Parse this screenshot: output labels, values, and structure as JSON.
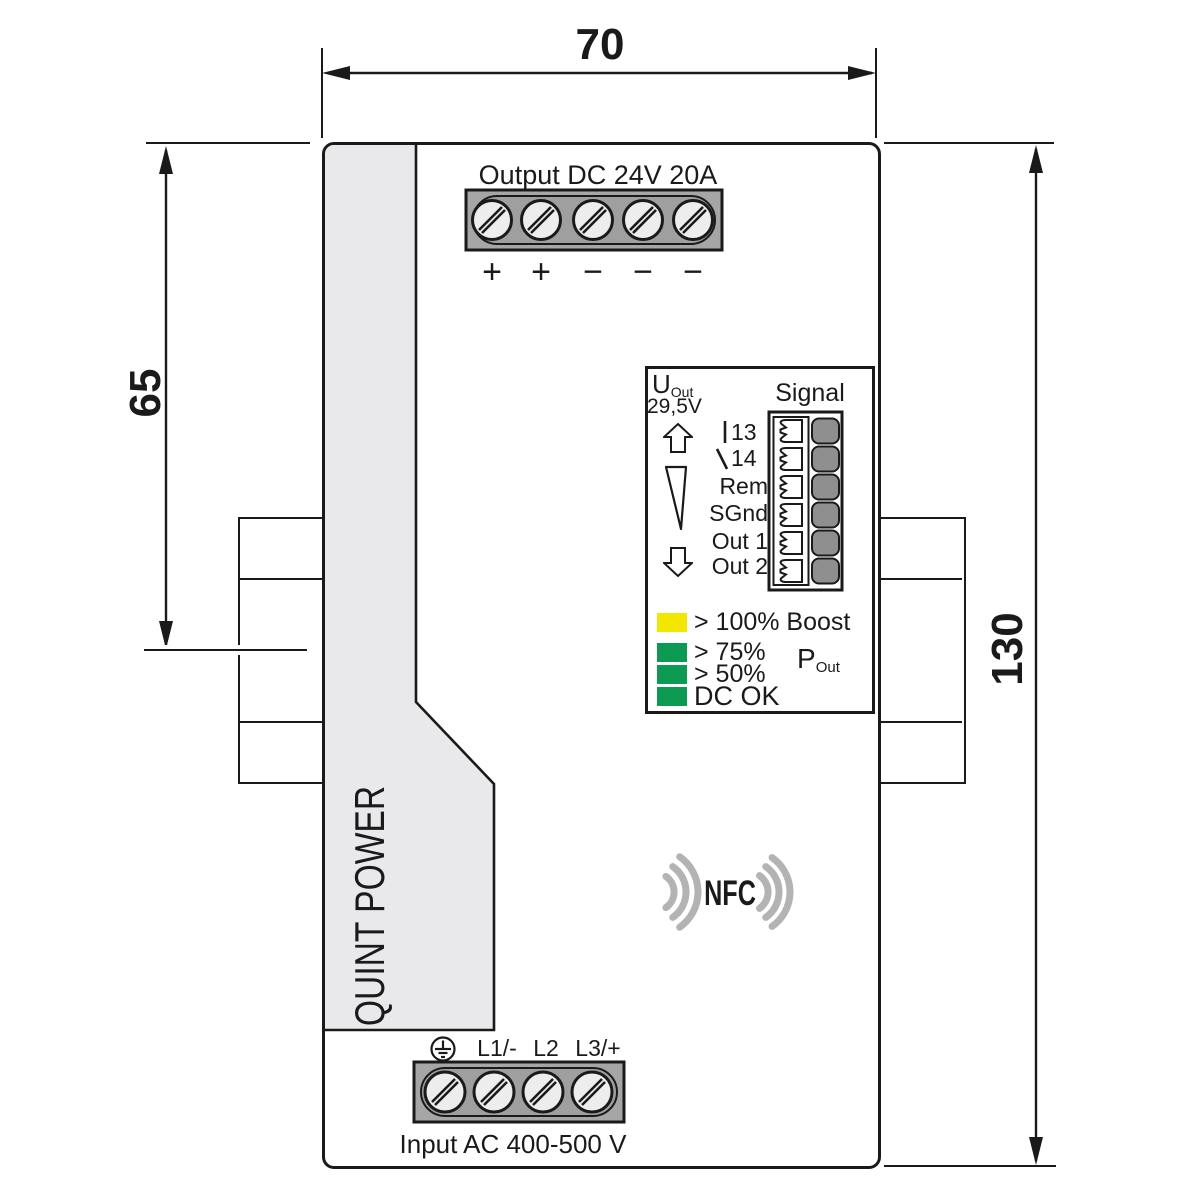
{
  "diagram": {
    "dim_width": "70",
    "dim_side_height": "65",
    "dim_total_height": "130"
  },
  "output": {
    "title": "Output DC 24V 20A",
    "polarity": [
      "+",
      "+",
      "−",
      "−",
      "−"
    ]
  },
  "signal_panel": {
    "u_label": "U",
    "u_sub": "Out",
    "u_value": "29,5V",
    "header": "Signal",
    "contact_13": "13",
    "contact_14": "14",
    "labels": [
      "Rem",
      "SGnd",
      "Out 1",
      "Out 2"
    ],
    "led_boost": "> 100% Boost",
    "led_75": "> 75%",
    "led_50": "> 50%",
    "led_dcok": "DC OK",
    "p_label": "P",
    "p_sub": "Out"
  },
  "nfc_label": "NFC",
  "brand_label": "QUINT POWER",
  "input": {
    "phases": [
      "L1/-",
      "L2",
      "L3/+"
    ],
    "title": "Input AC 400-500 V"
  },
  "colors": {
    "led_yellow": "#F3E600",
    "led_green": "#0D9B53",
    "button_gray": "#8F8F8F",
    "panel_gray": "#E9E9EB",
    "wave_gray": "#B3B3B3",
    "terminal_gray": "#A6A6A6",
    "terminal_inner_gray": "#9F9F9F",
    "screw_gray": "#EDEDED"
  }
}
